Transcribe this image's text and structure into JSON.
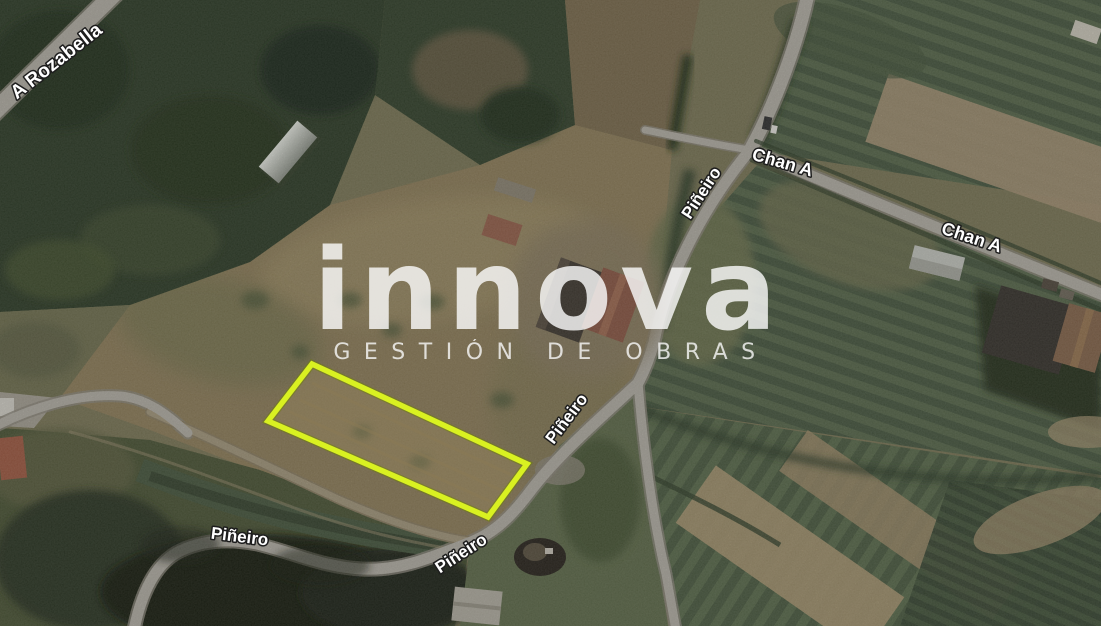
{
  "map": {
    "view": "satellite",
    "watermark": {
      "wordmark": "innova",
      "tagline": "GESTIÓN DE OBRAS",
      "color": "#ffffff"
    },
    "labels": {
      "a_rozabella": "A Rozabella",
      "pineiro_north": "Piñeiro",
      "chan_a_west": "Chan A",
      "chan_a_east": "Chan A",
      "pineiro_mid": "Piñeiro",
      "pineiro_southwest": "Piñeiro",
      "pineiro_south": "Piñeiro"
    },
    "highlight": {
      "stroke": "#d9f121"
    }
  }
}
